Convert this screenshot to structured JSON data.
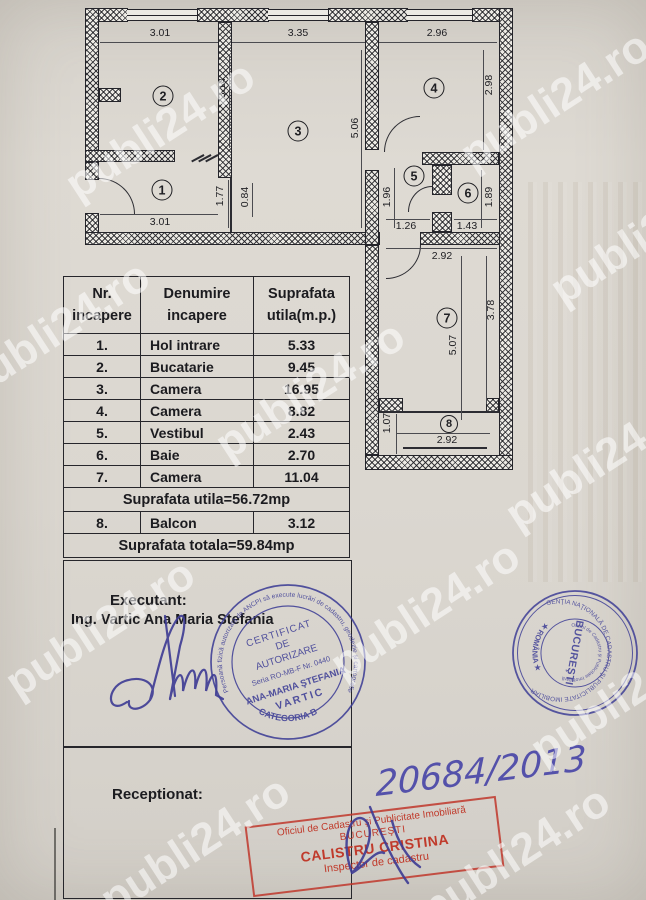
{
  "watermark": {
    "text": "publi24.ro"
  },
  "plan": {
    "rooms": {
      "r1": "1",
      "r2": "2",
      "r3": "3",
      "r4": "4",
      "r5": "5",
      "r6": "6",
      "r7": "7",
      "r8": "8"
    },
    "dims": {
      "d2_top": "3.01",
      "d3_top": "3.35",
      "d4_top": "2.96",
      "d2_h": "3.14",
      "d3_h": "5.06",
      "d4_h": "2.98",
      "d1_h": "1.77",
      "d1_door": "0.84",
      "d1_bottom": "3.01",
      "d5_h": "1.96",
      "d5_w": "1.26",
      "d6_h": "1.89",
      "d6_w": "1.43",
      "d7_top": "2.92",
      "d7_h": "5.07",
      "d7_hr": "3.78",
      "d8_h": "1.07",
      "d8_w": "2.92"
    }
  },
  "table": {
    "header": {
      "col1_line1": "Nr.",
      "col1_line2": "incapere",
      "col2_line1": "Denumire",
      "col2_line2": "incapere",
      "col3_line1": "Suprafata",
      "col3_line2": "utila(m.p.)"
    },
    "rows": [
      {
        "nr": "1.",
        "name": "Hol intrare",
        "area": "5.33"
      },
      {
        "nr": "2.",
        "name": "Bucatarie",
        "area": "9.45"
      },
      {
        "nr": "3.",
        "name": "Camera",
        "area": "16.95"
      },
      {
        "nr": "4.",
        "name": "Camera",
        "area": "8.82"
      },
      {
        "nr": "5.",
        "name": "Vestibul",
        "area": "2.43"
      },
      {
        "nr": "6.",
        "name": "Baie",
        "area": "2.70"
      },
      {
        "nr": "7.",
        "name": "Camera",
        "area": "11.04"
      }
    ],
    "subtotal": "Suprafata utila=56.72mp",
    "balcony_row": {
      "nr": "8.",
      "name": "Balcon",
      "area": "3.12"
    },
    "total": "Suprafata totala=59.84mp"
  },
  "executant": {
    "label": "Executant:",
    "name": "Ing. Vartic Ana Maria Stefania"
  },
  "receptionat": {
    "label": "Receptionat:",
    "number": "20684/2013"
  },
  "stamps": {
    "authorization": {
      "ring": "Persoană fizică autorizată de ANCPI să execute lucrări de cadastru, geodezie şi cartografie",
      "ring_bottom": "CATEGORIA B",
      "line1": "CERTIFICAT",
      "line2": "DE",
      "line3": "AUTORIZARE",
      "line4": "Seria RO-MB-F Nr. 0440",
      "line5": "ANA-MARIA ŞTEFANIA",
      "line6": "VARTIC"
    },
    "ancpi": {
      "ring": "AGENŢIA NAŢIONALĂ DE CADASTRU ŞI PUBLICITATE IMOBILIARĂ",
      "ring_bottom": "★ ROMÂNIA ★",
      "inner_ring": "Oficiul de Cadastru şi Publicitate Imobiliară",
      "center": "BUCUREŞTI"
    },
    "inspector": {
      "line1": "Oficiul de Cadastru şi Publicitate Imobiliară",
      "line2": "BUCUREŞTI",
      "line3": "CALISTRU CRISTINA",
      "line4": "Inspector de cadastru"
    }
  },
  "colors": {
    "paper": "#dbd7d0",
    "line": "#26262b",
    "stamp_blue": "#3e3e96",
    "stamp_red": "#c03a2b",
    "ink_blue": "#4a47a8"
  }
}
